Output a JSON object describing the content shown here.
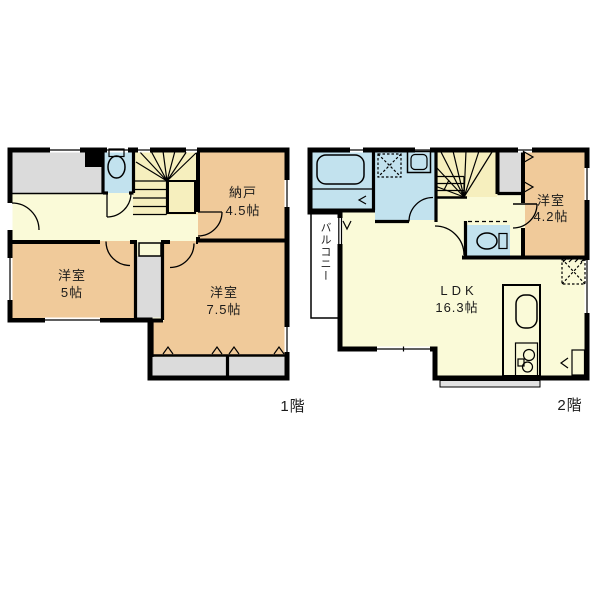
{
  "page": {
    "background": "#ffffff"
  },
  "floors": {
    "first": {
      "label": "1階",
      "rooms": {
        "storage": {
          "name": "納戸",
          "area": "4.5帖"
        },
        "bedroom5": {
          "name": "洋室",
          "area": "5帖"
        },
        "bedroom75": {
          "name": "洋室",
          "area": "7.5帖"
        }
      }
    },
    "second": {
      "label": "2階",
      "rooms": {
        "bedroom42": {
          "name": "洋室",
          "area": "4.2帖"
        },
        "ldk": {
          "name": "LDK",
          "area": "16.3帖"
        },
        "balcony": {
          "name": "バルコニー"
        }
      }
    }
  },
  "colors": {
    "wall": "#000000",
    "room_tan": "#F0CA9A",
    "hall_yellow": "#FAFAD8",
    "stairs_yellow": "#F6EFBE",
    "wet_blue": "#C2E2EE",
    "closet_gray": "#DBDBDB",
    "balcony_gray": "#E6E6E6",
    "fixture_yellow": "#F8F4B0",
    "text": "#1A1A1A"
  }
}
